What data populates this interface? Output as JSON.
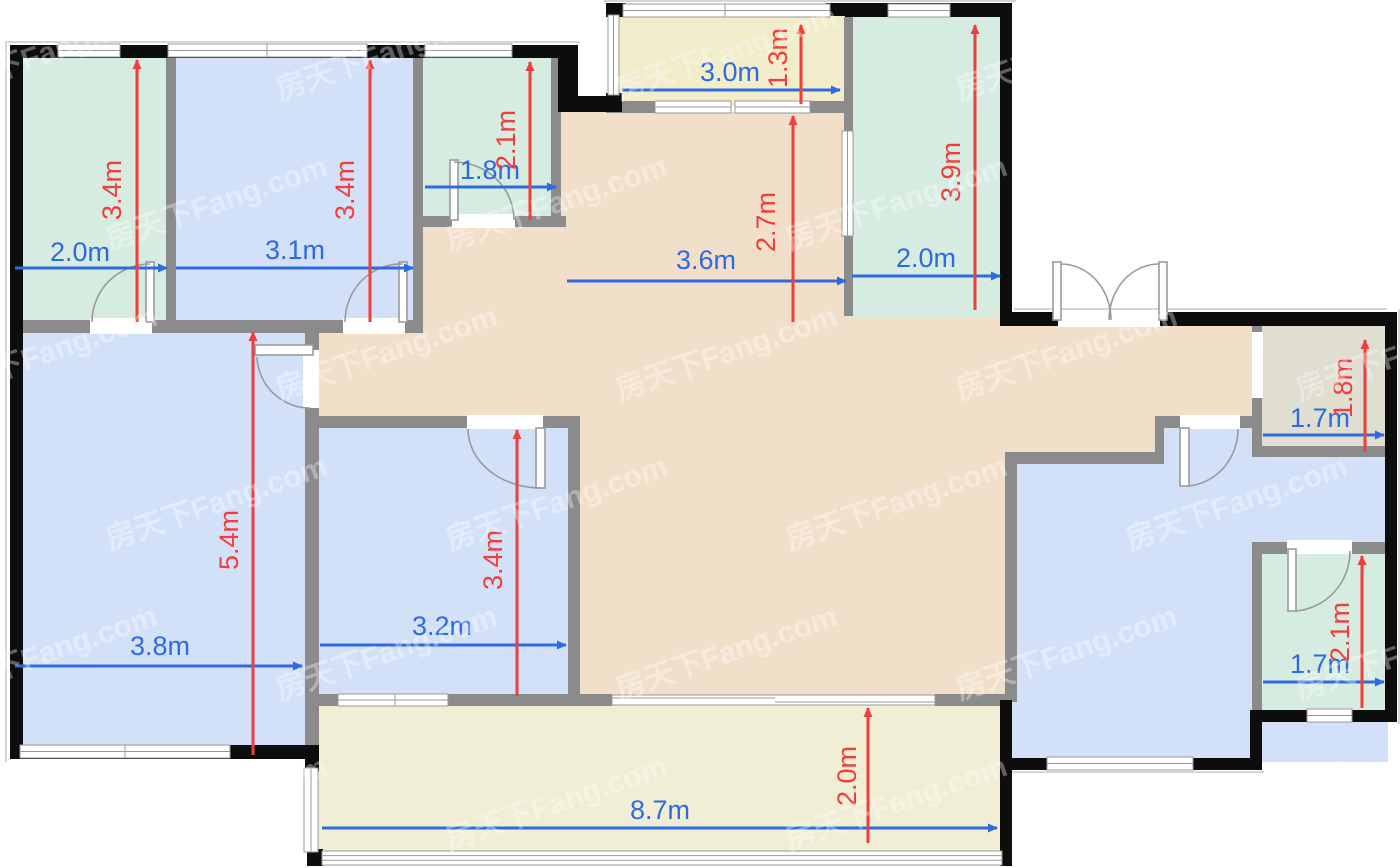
{
  "watermark": {
    "text": "房天下Fang.com",
    "opacity": 0.34,
    "color": "#ffffff"
  },
  "colors": {
    "wall_black": "#0d0d0d",
    "wall_grey": "#8b8b8b",
    "room_green": "#d6ece1",
    "room_blue": "#d3e1f8",
    "room_tan": "#f2dfca",
    "balcony_yellow": "#f1ecc9",
    "balcony_cream": "#f0eed4",
    "room_beige": "#dfded0",
    "dim_blue": "#2e6ae0",
    "dim_red": "#f23d3d",
    "door_stroke": "#9a9a9a",
    "window_stroke": "#999999",
    "outline_grey": "#c8c8c8"
  },
  "dimensions": {
    "horizontal": [
      {
        "room": "bedroom-top-left",
        "label": "2.0m",
        "meters": 2.0,
        "x1": 15,
        "x2": 167,
        "y": 268,
        "lx": 80,
        "ly": 252
      },
      {
        "room": "bedroom-top-second",
        "label": "3.1m",
        "meters": 3.1,
        "x1": 176,
        "x2": 413,
        "y": 268,
        "lx": 295,
        "ly": 250
      },
      {
        "room": "bath-top",
        "label": "1.8m",
        "meters": 1.8,
        "x1": 425,
        "x2": 556,
        "y": 187,
        "lx": 490,
        "ly": 170
      },
      {
        "room": "balcony-top",
        "label": "3.0m",
        "meters": 3.0,
        "x1": 622,
        "x2": 840,
        "y": 90,
        "lx": 730,
        "ly": 72
      },
      {
        "room": "bedroom-top-right",
        "label": "2.0m",
        "meters": 2.0,
        "x1": 852,
        "x2": 1000,
        "y": 276,
        "lx": 926,
        "ly": 258
      },
      {
        "room": "dining",
        "label": "3.6m",
        "meters": 3.6,
        "x1": 567,
        "x2": 846,
        "y": 281,
        "lx": 706,
        "ly": 260
      },
      {
        "room": "storage-right",
        "label": "1.7m",
        "meters": 1.7,
        "x1": 1263,
        "x2": 1384,
        "y": 435,
        "lx": 1320,
        "ly": 418
      },
      {
        "room": "bath-right",
        "label": "1.7m",
        "meters": 1.7,
        "x1": 1263,
        "x2": 1384,
        "y": 682,
        "lx": 1320,
        "ly": 664
      },
      {
        "room": "living",
        "label": "3.8m",
        "meters": 3.8,
        "x1": 15,
        "x2": 302,
        "y": 666,
        "lx": 160,
        "ly": 646
      },
      {
        "room": "bedroom-middle",
        "label": "3.2m",
        "meters": 3.2,
        "x1": 320,
        "x2": 566,
        "y": 645,
        "lx": 442,
        "ly": 626
      },
      {
        "room": "balcony-bottom",
        "label": "8.7m",
        "meters": 8.7,
        "x1": 322,
        "x2": 997,
        "y": 828,
        "lx": 660,
        "ly": 810
      }
    ],
    "vertical": [
      {
        "room": "bedroom-top-left",
        "label": "3.4m",
        "meters": 3.4,
        "x": 137,
        "y1": 60,
        "y2": 322,
        "lx": 112,
        "ly": 190
      },
      {
        "room": "bedroom-top-second",
        "label": "3.4m",
        "meters": 3.4,
        "x": 370,
        "y1": 60,
        "y2": 322,
        "lx": 345,
        "ly": 190
      },
      {
        "room": "bath-top",
        "label": "2.1m",
        "meters": 2.1,
        "x": 530,
        "y1": 62,
        "y2": 220,
        "lx": 506,
        "ly": 140
      },
      {
        "room": "balcony-top",
        "label": "1.3m",
        "meters": 1.3,
        "x": 801,
        "y1": 25,
        "y2": 104,
        "lx": 778,
        "ly": 58
      },
      {
        "room": "dining",
        "label": "2.7m",
        "meters": 2.7,
        "x": 793,
        "y1": 116,
        "y2": 322,
        "lx": 766,
        "ly": 222
      },
      {
        "room": "bedroom-top-right",
        "label": "3.9m",
        "meters": 3.9,
        "x": 975,
        "y1": 25,
        "y2": 310,
        "lx": 951,
        "ly": 172
      },
      {
        "room": "storage-right",
        "label": "1.8m",
        "meters": 1.8,
        "x": 1365,
        "y1": 340,
        "y2": 452,
        "lx": 1343,
        "ly": 388
      },
      {
        "room": "bath-right",
        "label": "2.1m",
        "meters": 2.1,
        "x": 1362,
        "y1": 556,
        "y2": 708,
        "lx": 1340,
        "ly": 632
      },
      {
        "room": "living",
        "label": "5.4m",
        "meters": 5.4,
        "x": 253,
        "y1": 332,
        "y2": 755,
        "lx": 229,
        "ly": 540
      },
      {
        "room": "bedroom-middle",
        "label": "3.4m",
        "meters": 3.4,
        "x": 517,
        "y1": 430,
        "y2": 696,
        "lx": 493,
        "ly": 560
      },
      {
        "room": "balcony-bottom",
        "label": "2.0m",
        "meters": 2.0,
        "x": 868,
        "y1": 708,
        "y2": 843,
        "lx": 847,
        "ly": 776
      }
    ]
  }
}
